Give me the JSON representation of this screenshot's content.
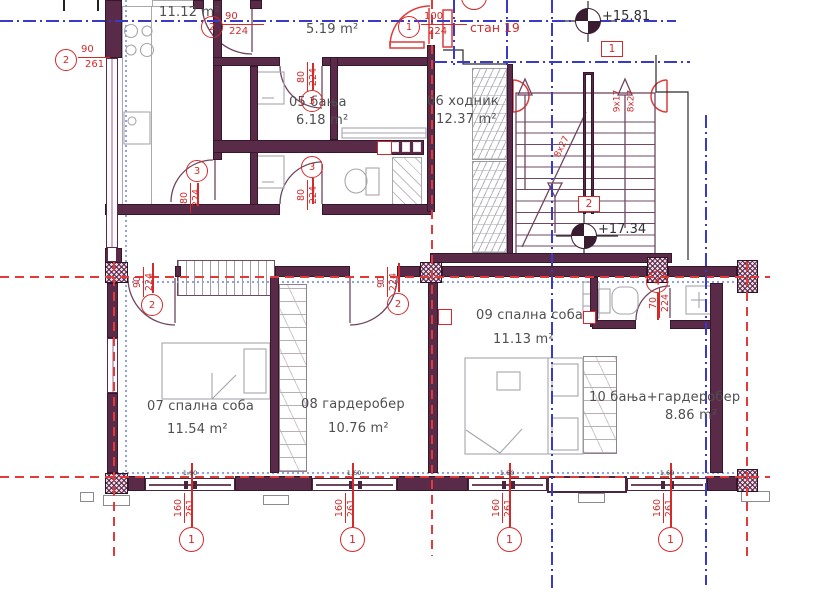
{
  "drawing": {
    "apartment_tag": "стан 19",
    "rooms": [
      {
        "name": "",
        "nx": 0,
        "ny": 0,
        "area": "11.12 m²",
        "ax": 159,
        "ay": 5
      },
      {
        "name": "",
        "nx": 0,
        "ny": 0,
        "area": "5.19 m²",
        "ax": 306,
        "ay": 22
      },
      {
        "name": "05 бања",
        "nx": 289,
        "ny": 95,
        "area": "6.18 m²",
        "ax": 296,
        "ay": 113
      },
      {
        "name": "06 ходник",
        "nx": 427,
        "ny": 94,
        "area": "12.37 m²",
        "ax": 436,
        "ay": 112
      },
      {
        "name": "07 спална соба",
        "nx": 147,
        "ny": 399,
        "area": "11.54 m²",
        "ax": 167,
        "ay": 422
      },
      {
        "name": "08 гардеробер",
        "nx": 301,
        "ny": 397,
        "area": "10.76 m²",
        "ax": 328,
        "ay": 421
      },
      {
        "name": "09 спална соба",
        "nx": 476,
        "ny": 308,
        "area": "11.13 m²",
        "ax": 493,
        "ay": 332
      },
      {
        "name": "10 бања+гардеробер",
        "nx": 589,
        "ny": 390,
        "area": "8.86 m²",
        "ax": 665,
        "ay": 408
      }
    ],
    "levels": [
      {
        "text": "+15.81",
        "tx": 602,
        "ty": 9,
        "cx": 575,
        "cy": 8
      },
      {
        "text": "+17.34",
        "tx": 598,
        "ty": 222,
        "cx": 571,
        "cy": 223
      }
    ],
    "stair_boxes": [
      {
        "text": "1",
        "x": 601,
        "y": 41
      },
      {
        "text": "2",
        "x": 578,
        "y": 196
      }
    ],
    "stair_notes": [
      {
        "text": "9x17",
        "x": 606,
        "y": 96,
        "rot": -90
      },
      {
        "text": "8x27",
        "x": 620,
        "y": 96,
        "rot": -90
      },
      {
        "text": "8x27",
        "x": 551,
        "y": 142,
        "rot": -64
      }
    ],
    "door_marks": [
      {
        "num": "2",
        "top": "90",
        "bot": "261",
        "layout": "h",
        "cx": 55,
        "cy": 49,
        "fx": 78,
        "fy": 44,
        "fw": 32
      },
      {
        "num": "2",
        "top": "90",
        "bot": "224",
        "layout": "h",
        "cx": 201,
        "cy": 16,
        "fx": 222,
        "fy": 11,
        "fw": 42
      },
      {
        "num": "1",
        "top": "100",
        "bot": "224",
        "layout": "h",
        "cx": 398,
        "cy": 16,
        "fx": 421,
        "fy": 11,
        "fw": 46
      },
      {
        "num": "3",
        "top": "80",
        "bot": "224",
        "layout": "v",
        "cx": 186,
        "cy": 160,
        "fx": 181,
        "fy": 181,
        "line": [
          197,
          183,
          197,
          206
        ]
      },
      {
        "num": "3",
        "top": "80",
        "bot": "224",
        "layout": "v",
        "cx": 301,
        "cy": 90,
        "fx": 298,
        "fy": 60,
        "line": [
          312,
          63,
          312,
          90
        ]
      },
      {
        "num": "3",
        "top": "80",
        "bot": "224",
        "layout": "v",
        "cx": 301,
        "cy": 156,
        "fx": 298,
        "fy": 178,
        "line": [
          312,
          178,
          312,
          204
        ]
      },
      {
        "num": "2",
        "top": "90",
        "bot": "224",
        "layout": "v",
        "cx": 141,
        "cy": 294,
        "fx": 134,
        "fy": 265,
        "line": [
          152,
          263,
          152,
          293
        ]
      },
      {
        "num": "2",
        "top": "90",
        "bot": "224",
        "layout": "v",
        "cx": 387,
        "cy": 293,
        "fx": 378,
        "fy": 265,
        "line": [
          398,
          263,
          398,
          292
        ]
      },
      {
        "num": "4",
        "top": "70",
        "bot": "224",
        "layout": "v",
        "cx": 646,
        "cy": 271,
        "fx": 650,
        "fy": 286,
        "line": [
          657,
          293,
          657,
          320
        ]
      }
    ],
    "axis_marks": [
      {
        "num": "1",
        "top": "160",
        "bot": "261",
        "x": 192
      },
      {
        "num": "1",
        "top": "160",
        "bot": "261",
        "x": 353
      },
      {
        "num": "1",
        "top": "160",
        "bot": "261",
        "x": 510
      },
      {
        "num": "1",
        "top": "160",
        "bot": "261",
        "x": 671
      }
    ],
    "window_marks": [
      {
        "text": "1.60",
        "x": 172
      },
      {
        "text": "1.60",
        "x": 336
      },
      {
        "text": "1.60",
        "x": 489
      },
      {
        "text": "1.60",
        "x": 649
      }
    ],
    "windows": [
      {
        "x": 145,
        "w": 90
      },
      {
        "x": 312,
        "w": 85
      },
      {
        "x": 468,
        "w": 79
      },
      {
        "x": 627,
        "w": 80
      }
    ]
  }
}
